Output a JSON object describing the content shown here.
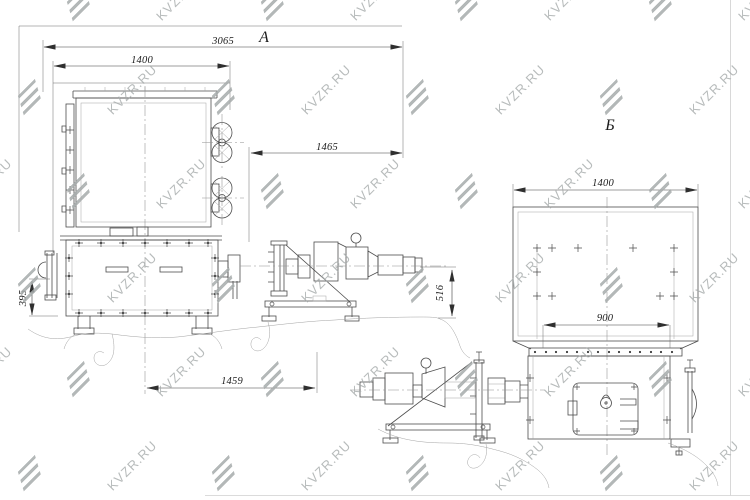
{
  "watermark": {
    "text": "KVZR.RU"
  },
  "views": {
    "a": {
      "label": "А",
      "dims": {
        "overall": "3065",
        "box": "1400",
        "shaft": "1465",
        "base": "1459",
        "height": "395",
        "drive": "516"
      }
    },
    "b": {
      "label": "Б",
      "dims": {
        "box": "1400",
        "base": "900"
      }
    }
  },
  "colors": {
    "background": "#ffffff",
    "line": "#4d4d4d",
    "dim_text": "#1c1c1c",
    "watermark": "#a6abab"
  }
}
